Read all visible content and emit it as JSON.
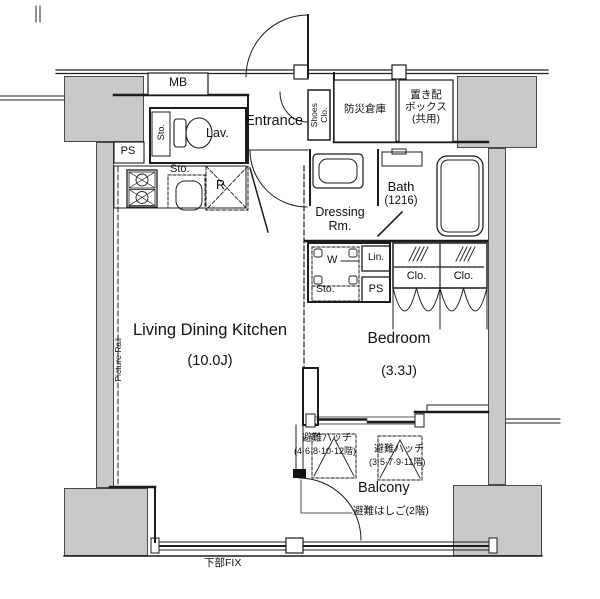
{
  "meta": {
    "type": "floor-plan",
    "units": "Japanese apartment 1K/1LDK layout"
  },
  "colors": {
    "structure_fill": "#c9c9c9",
    "line": "#1c1c1c",
    "background": "#ffffff"
  },
  "rooms": {
    "ldk": {
      "name": "Living Dining Kitchen",
      "size": "(10.0J)"
    },
    "bedroom": {
      "name": "Bedroom",
      "size": "(3.3J)"
    },
    "entrance": {
      "name": "Entrance"
    },
    "lavatory": {
      "name": "Lav."
    },
    "dressing": {
      "name_1": "Dressing",
      "name_2": "Rm."
    },
    "bath": {
      "name": "Bath",
      "size": "(1216)"
    },
    "balcony": {
      "name": "Balcony"
    }
  },
  "labels": {
    "mb": "MB",
    "bousai_souko": "防災倉庫",
    "okihai_1": "置き配",
    "okihai_2": "ボックス",
    "okihai_3": "(共用)",
    "ps_upper": "PS",
    "sto_lavatory": "Sto.",
    "shoes_1": "Shoes",
    "shoes_2": "Clo.",
    "sto_kitchen": "Sto.",
    "refrigerator": "R",
    "washer": "W",
    "linen": "Lin.",
    "sto_block": "Sto.",
    "ps_lower": "PS",
    "closet_1": "Clo.",
    "closet_2": "Clo.",
    "picture_rail": "Picture Rail",
    "hatch1_name": "避難ハッチ",
    "hatch1_floors": "(4·6·8·10·12階)",
    "hatch2_name": "避難ハッチ",
    "hatch2_floors": "(3·5·7·9·11階)",
    "ladder": "避難はしご(2階)",
    "bottom_fix": "下部FIX"
  }
}
